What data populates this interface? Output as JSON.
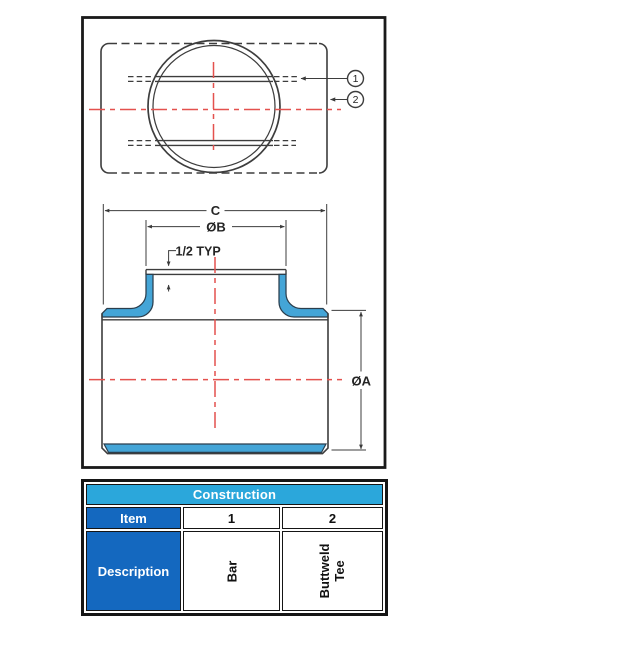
{
  "drawing": {
    "dimensions": {
      "overall_width": "C",
      "branch_od": "ØB",
      "typ_note": "1/2 TYP",
      "run_od": "ØA"
    },
    "balloons": [
      "1",
      "2"
    ]
  },
  "table": {
    "title": "Construction",
    "row_header_item": "Item",
    "row_header_description": "Description",
    "columns": [
      {
        "item": "1",
        "description": "Bar"
      },
      {
        "item": "2",
        "description": "Buttweld Tee"
      }
    ]
  },
  "colors": {
    "header_cyan": "#2BA7DB",
    "header_blue": "#1468BF",
    "highlight_blue": "#44A5D7",
    "centerline_red": "#E4514E",
    "line_dark": "#3a3a3a"
  }
}
